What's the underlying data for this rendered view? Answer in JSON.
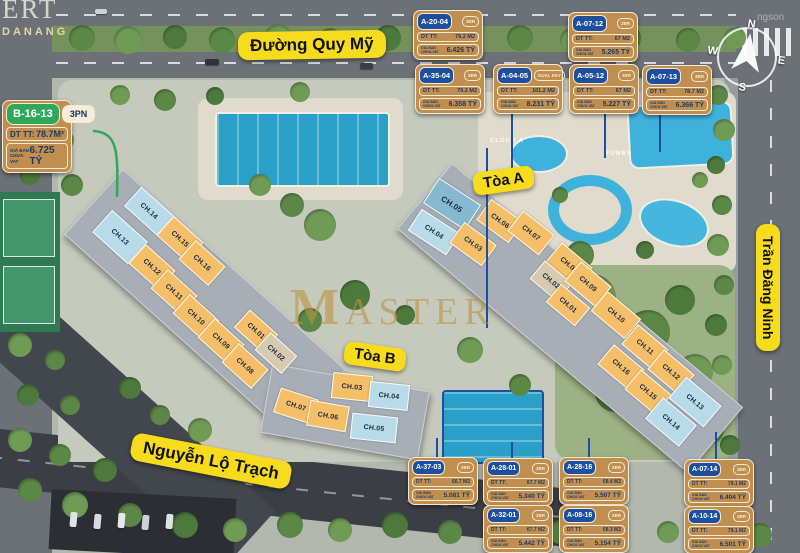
{
  "streets": {
    "quy_my": "Đường Quy Mỹ",
    "nguyen_lo_trach": "Nguyễn Lộ Trạch",
    "tran_dang_ninh": "Trần Đăng Ninh"
  },
  "compass": {
    "n": "N",
    "e": "E",
    "s": "S",
    "w": "W"
  },
  "watermark": {
    "corner_line1": "ERT",
    "corner_line2": "DANANG",
    "center": "MASTER",
    "photographer": "ngson"
  },
  "map_labels": {
    "cloud": "CLOUD A",
    "funny": "FUNNY"
  },
  "card_labels": {
    "area_label": "DT TT:",
    "price_label_line1": "GIÁ BÁN",
    "price_label_line2": "CHƯA VAT"
  },
  "cards": [
    {
      "code": "B-16-13",
      "badge": "3PN",
      "area": "78.7M²",
      "price": "6.725 TỶ",
      "style": "green",
      "size": "lg",
      "x": 2,
      "y": 100
    },
    {
      "code": "A-20-04",
      "badge": "3BR",
      "area": "79.2 M2",
      "price": "6.426 TỶ",
      "style": "navy",
      "size": "md",
      "x": 413,
      "y": 10
    },
    {
      "code": "A-07-12",
      "badge": "2BR",
      "area": "67 M2",
      "price": "5.265 TỶ",
      "style": "navy",
      "size": "md",
      "x": 568,
      "y": 12
    },
    {
      "code": "A-35-04",
      "badge": "3BR",
      "area": "79.2 M2",
      "price": "6.358 TỶ",
      "style": "navy",
      "size": "md",
      "x": 415,
      "y": 64
    },
    {
      "code": "A-04-05",
      "badge": "DUAL KEY",
      "area": "101.2 M2",
      "price": "8.231 TỶ",
      "style": "navy",
      "size": "md",
      "x": 493,
      "y": 64
    },
    {
      "code": "A-05-12",
      "badge": "2BR",
      "area": "67 M2",
      "price": "5.227 TỶ",
      "style": "navy",
      "size": "md",
      "x": 569,
      "y": 64
    },
    {
      "code": "A-07-13",
      "badge": "3BR",
      "area": "78.7 M2",
      "price": "6.366 TỶ",
      "style": "navy",
      "size": "md",
      "x": 642,
      "y": 65
    },
    {
      "code": "A-37-03",
      "badge": "2BR",
      "area": "66.7 M2",
      "price": "5.081 TỶ",
      "style": "navy",
      "size": "sm",
      "x": 408,
      "y": 457
    },
    {
      "code": "A-28-01",
      "badge": "2BR",
      "area": "67.7 M2",
      "price": "5.340 TỶ",
      "style": "navy",
      "size": "sm",
      "x": 483,
      "y": 458
    },
    {
      "code": "A-28-16",
      "badge": "2BR",
      "area": "68.4 M2",
      "price": "5.507 TỶ",
      "style": "navy",
      "size": "sm",
      "x": 559,
      "y": 457
    },
    {
      "code": "A-07-14",
      "badge": "3BR",
      "area": "79.1 M2",
      "price": "6.404 TỶ",
      "style": "navy",
      "size": "sm",
      "x": 684,
      "y": 459
    },
    {
      "code": "A-32-01",
      "badge": "2BR",
      "area": "67.7 M2",
      "price": "5.442 TỶ",
      "style": "navy",
      "size": "sm",
      "x": 483,
      "y": 505
    },
    {
      "code": "A-08-16",
      "badge": "2BR",
      "area": "68.3 M2",
      "price": "5.154 TỶ",
      "style": "navy",
      "size": "sm",
      "x": 559,
      "y": 505
    },
    {
      "code": "A-10-14",
      "badge": "3BR",
      "area": "79.1 M2",
      "price": "6.501 TỶ",
      "style": "navy",
      "size": "sm",
      "x": 684,
      "y": 506
    }
  ],
  "buildings": [
    {
      "id": "toa-a",
      "label": "Tòa A",
      "units": [
        {
          "n": "CH.05",
          "x": 452,
          "y": 204,
          "r": 33,
          "w": 50,
          "h": 30,
          "c": "teal"
        },
        {
          "n": "CH.04",
          "x": 434,
          "y": 232,
          "r": 33,
          "w": 46,
          "h": 26,
          "c": "blue"
        },
        {
          "n": "CH.03",
          "x": 473,
          "y": 244,
          "r": 36,
          "c": "orange"
        },
        {
          "n": "CH.06",
          "x": 500,
          "y": 221,
          "r": 36,
          "c": "orange"
        },
        {
          "n": "CH.07",
          "x": 531,
          "y": 233,
          "r": 38,
          "c": "orange"
        },
        {
          "n": "CH.08",
          "x": 569,
          "y": 265,
          "r": 40,
          "c": "orange"
        },
        {
          "n": "CH.02",
          "x": 551,
          "y": 281,
          "r": 40,
          "w": 36,
          "h": 24,
          "c": "tan"
        },
        {
          "n": "CH.09",
          "x": 588,
          "y": 284,
          "r": 40,
          "c": "orange"
        },
        {
          "n": "CH.01",
          "x": 568,
          "y": 305,
          "r": 40,
          "w": 38,
          "h": 24,
          "c": "orange"
        },
        {
          "n": "CH.10",
          "x": 616,
          "y": 315,
          "r": 40,
          "w": 44,
          "h": 26,
          "c": "orange"
        },
        {
          "n": "CH.11",
          "x": 645,
          "y": 347,
          "r": 40,
          "c": "orange"
        },
        {
          "n": "CH.16",
          "x": 621,
          "y": 367,
          "r": 40,
          "c": "orange"
        },
        {
          "n": "CH.12",
          "x": 671,
          "y": 372,
          "r": 40,
          "c": "orange"
        },
        {
          "n": "CH.15",
          "x": 648,
          "y": 392,
          "r": 40,
          "c": "orange"
        },
        {
          "n": "CH.13",
          "x": 695,
          "y": 402,
          "r": 40,
          "w": 46,
          "h": 28,
          "c": "blue"
        },
        {
          "n": "CH.14",
          "x": 671,
          "y": 422,
          "r": 40,
          "w": 44,
          "h": 28,
          "c": "blue"
        }
      ]
    },
    {
      "id": "toa-b",
      "label": "Tòa B",
      "units": [
        {
          "n": "CH.14",
          "x": 149,
          "y": 211,
          "r": 42,
          "w": 44,
          "h": 26,
          "c": "blue"
        },
        {
          "n": "CH.13",
          "x": 120,
          "y": 237,
          "r": 42,
          "w": 48,
          "h": 30,
          "c": "blue"
        },
        {
          "n": "CH.15",
          "x": 180,
          "y": 239,
          "r": 42,
          "c": "orange"
        },
        {
          "n": "CH.12",
          "x": 152,
          "y": 267,
          "r": 42,
          "c": "orange"
        },
        {
          "n": "CH.16",
          "x": 202,
          "y": 263,
          "r": 42,
          "c": "orange"
        },
        {
          "n": "CH.11",
          "x": 174,
          "y": 292,
          "r": 42,
          "c": "orange"
        },
        {
          "n": "CH.10",
          "x": 196,
          "y": 317,
          "r": 42,
          "c": "orange"
        },
        {
          "n": "CH.09",
          "x": 221,
          "y": 341,
          "r": 42,
          "c": "orange"
        },
        {
          "n": "CH.01",
          "x": 256,
          "y": 331,
          "r": 42,
          "w": 38,
          "h": 24,
          "c": "orange"
        },
        {
          "n": "CH.08",
          "x": 245,
          "y": 366,
          "r": 42,
          "c": "orange"
        },
        {
          "n": "CH.02",
          "x": 276,
          "y": 353,
          "r": 42,
          "w": 36,
          "h": 24,
          "c": "tan"
        },
        {
          "n": "CH.07",
          "x": 296,
          "y": 406,
          "r": 18,
          "c": "orange"
        },
        {
          "n": "CH.06",
          "x": 328,
          "y": 416,
          "r": 10,
          "c": "orange"
        },
        {
          "n": "CH.03",
          "x": 352,
          "y": 387,
          "r": 6,
          "c": "orange"
        },
        {
          "n": "CH.04",
          "x": 389,
          "y": 396,
          "r": 6,
          "c": "blue"
        },
        {
          "n": "CH.05",
          "x": 374,
          "y": 428,
          "r": 6,
          "w": 46,
          "h": 26,
          "c": "blue"
        }
      ]
    }
  ]
}
